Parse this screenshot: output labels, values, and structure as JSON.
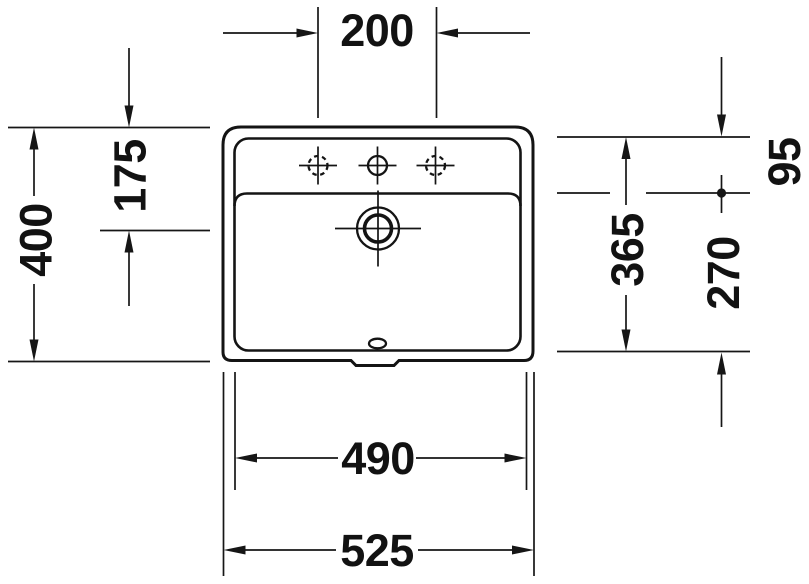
{
  "drawing": {
    "type": "washbasin-dimension-drawing",
    "view": "top",
    "dimensions": {
      "top": {
        "tap_hole_spacing": "200"
      },
      "left": {
        "overall_depth": "400",
        "back_edge_to_drain_center": "175"
      },
      "right": {
        "inner_depth": "365",
        "back_edge_to_basin_line": "95",
        "basin_line_to_front_edge": "270"
      },
      "bottom": {
        "basin_width": "490",
        "overall_width": "525"
      }
    },
    "features": [
      "outer-rim-outline",
      "inner-rim-outline",
      "basin-deck-line",
      "tap-hole-center",
      "tap-hole-left-dashed",
      "tap-hole-right-dashed",
      "drain-hole",
      "overflow-slot",
      "front-mounting-notch"
    ]
  }
}
